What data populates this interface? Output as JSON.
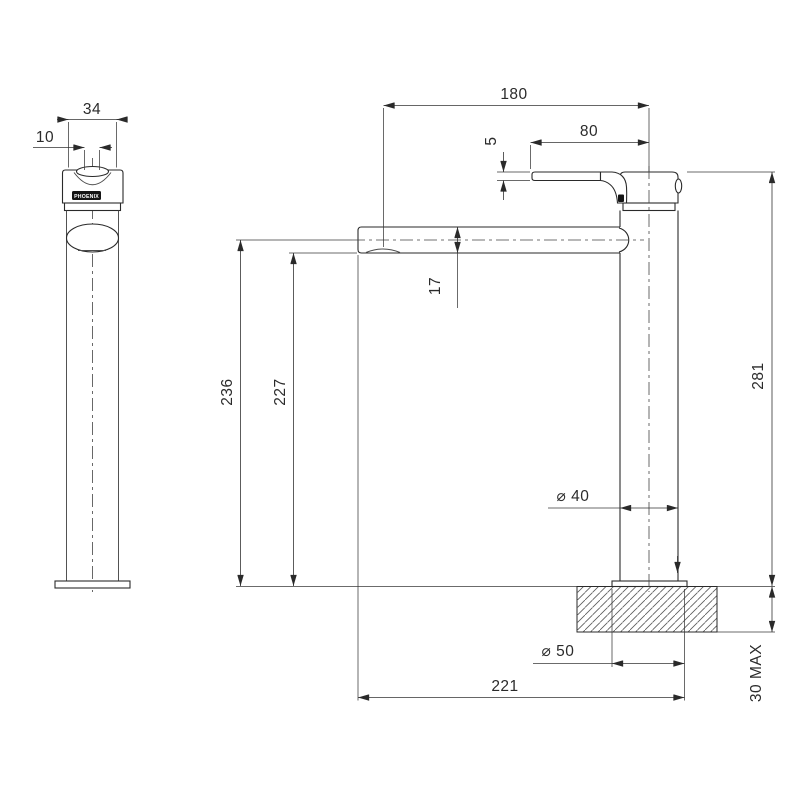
{
  "drawing": {
    "brand": "PHOENIX",
    "views": {
      "front": {
        "dims": {
          "head_width": "34",
          "lever_width": "10"
        }
      },
      "side": {
        "dims": {
          "reach_to_centre": "180",
          "lever_length": "80",
          "lever_tip_thickness": "5",
          "spout_tube_height": "17",
          "spout_centre_height": "236",
          "spout_underside_height": "227",
          "overall_height": "281",
          "body_diameter": "⌀ 40",
          "base_diameter": "⌀ 50",
          "overall_depth": "221",
          "bench_thickness_max": "30 MAX"
        }
      }
    }
  }
}
